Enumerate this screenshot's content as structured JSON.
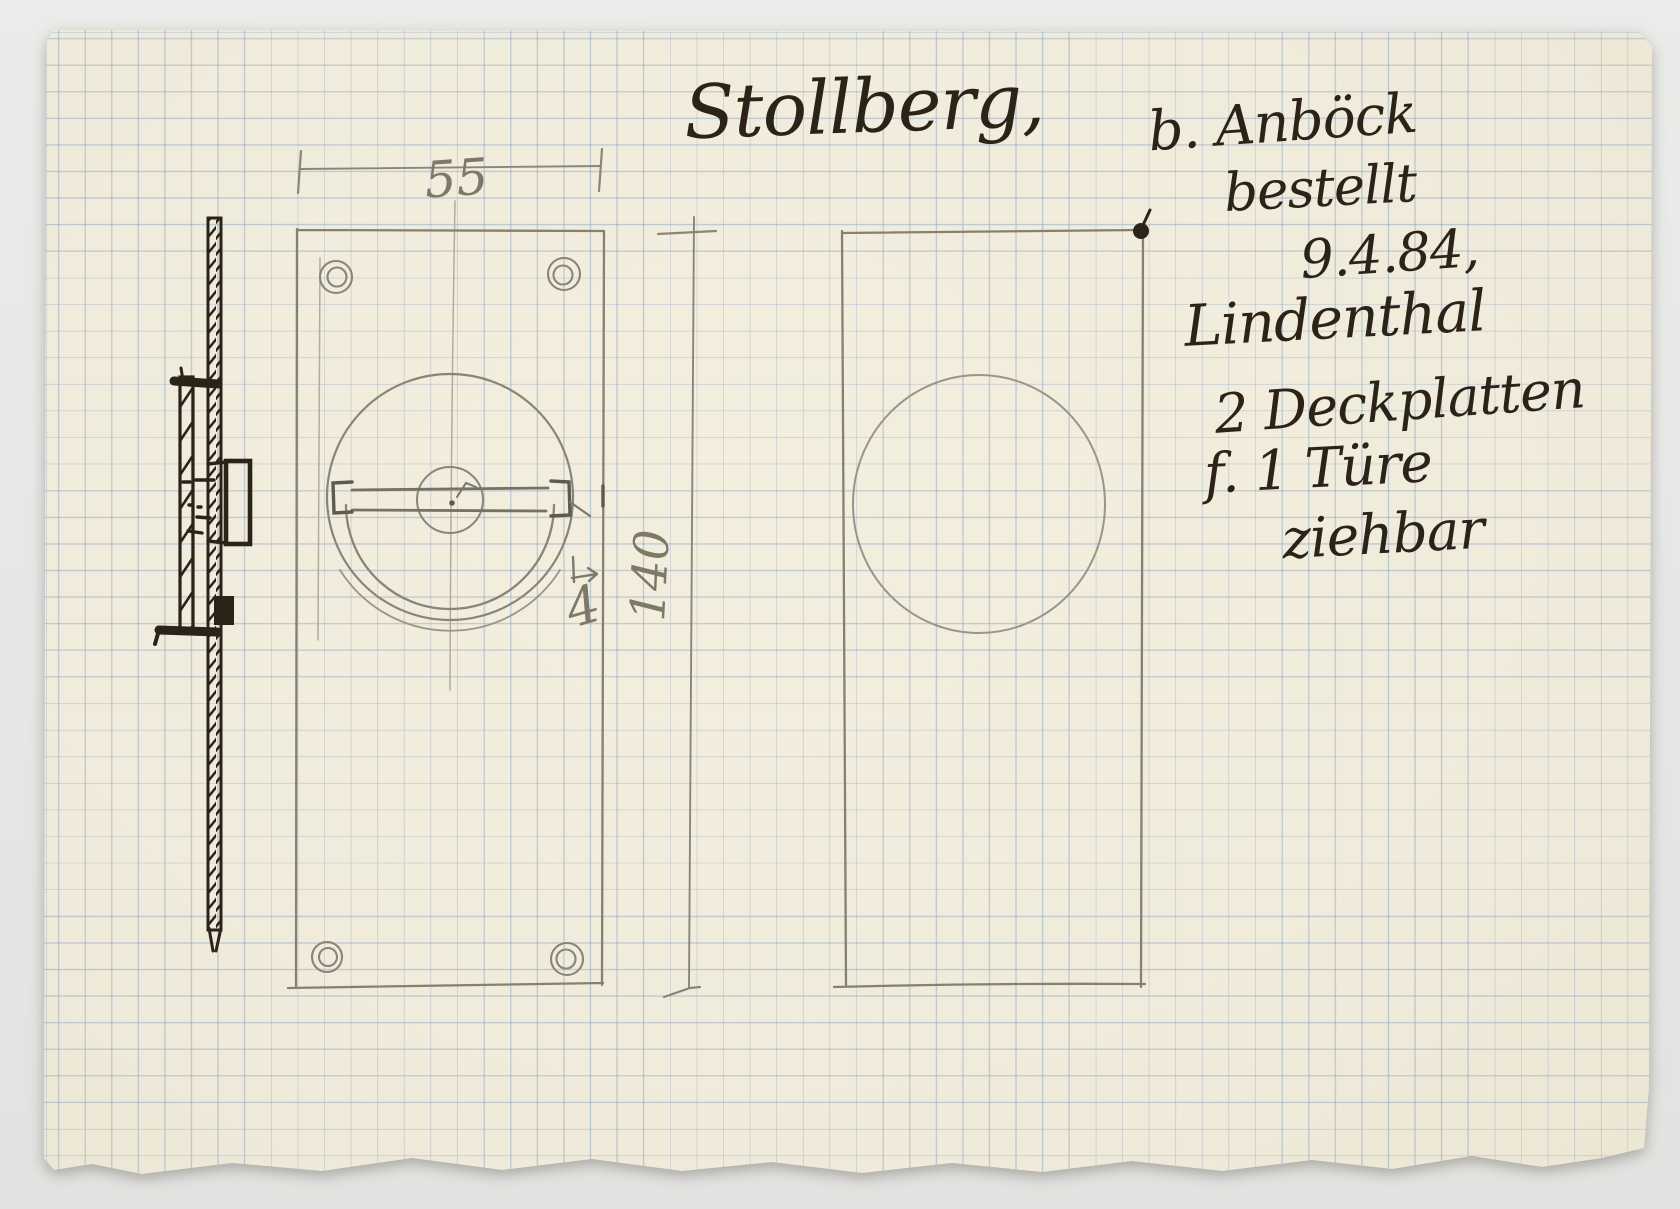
{
  "document": {
    "kind": "hand-drawn hardware sketch on graph paper",
    "notes": {
      "client": "Stollberg,",
      "supplier": "b. Anböck",
      "ordered": "bestellt",
      "date": "9.4.84,",
      "location": "Lindenthal",
      "item_qty": "2 Deckplatten",
      "item_for": "f. 1 Türe",
      "item_type": "ziehbar"
    },
    "dims": {
      "width": "55",
      "height": "140",
      "depth": "4"
    },
    "colors": {
      "paper": "#f1ecdc",
      "grid_blue": "#aebfd6",
      "ink": "#2c2318",
      "pencil": "#86806f",
      "background": "#e9e9e7"
    }
  }
}
